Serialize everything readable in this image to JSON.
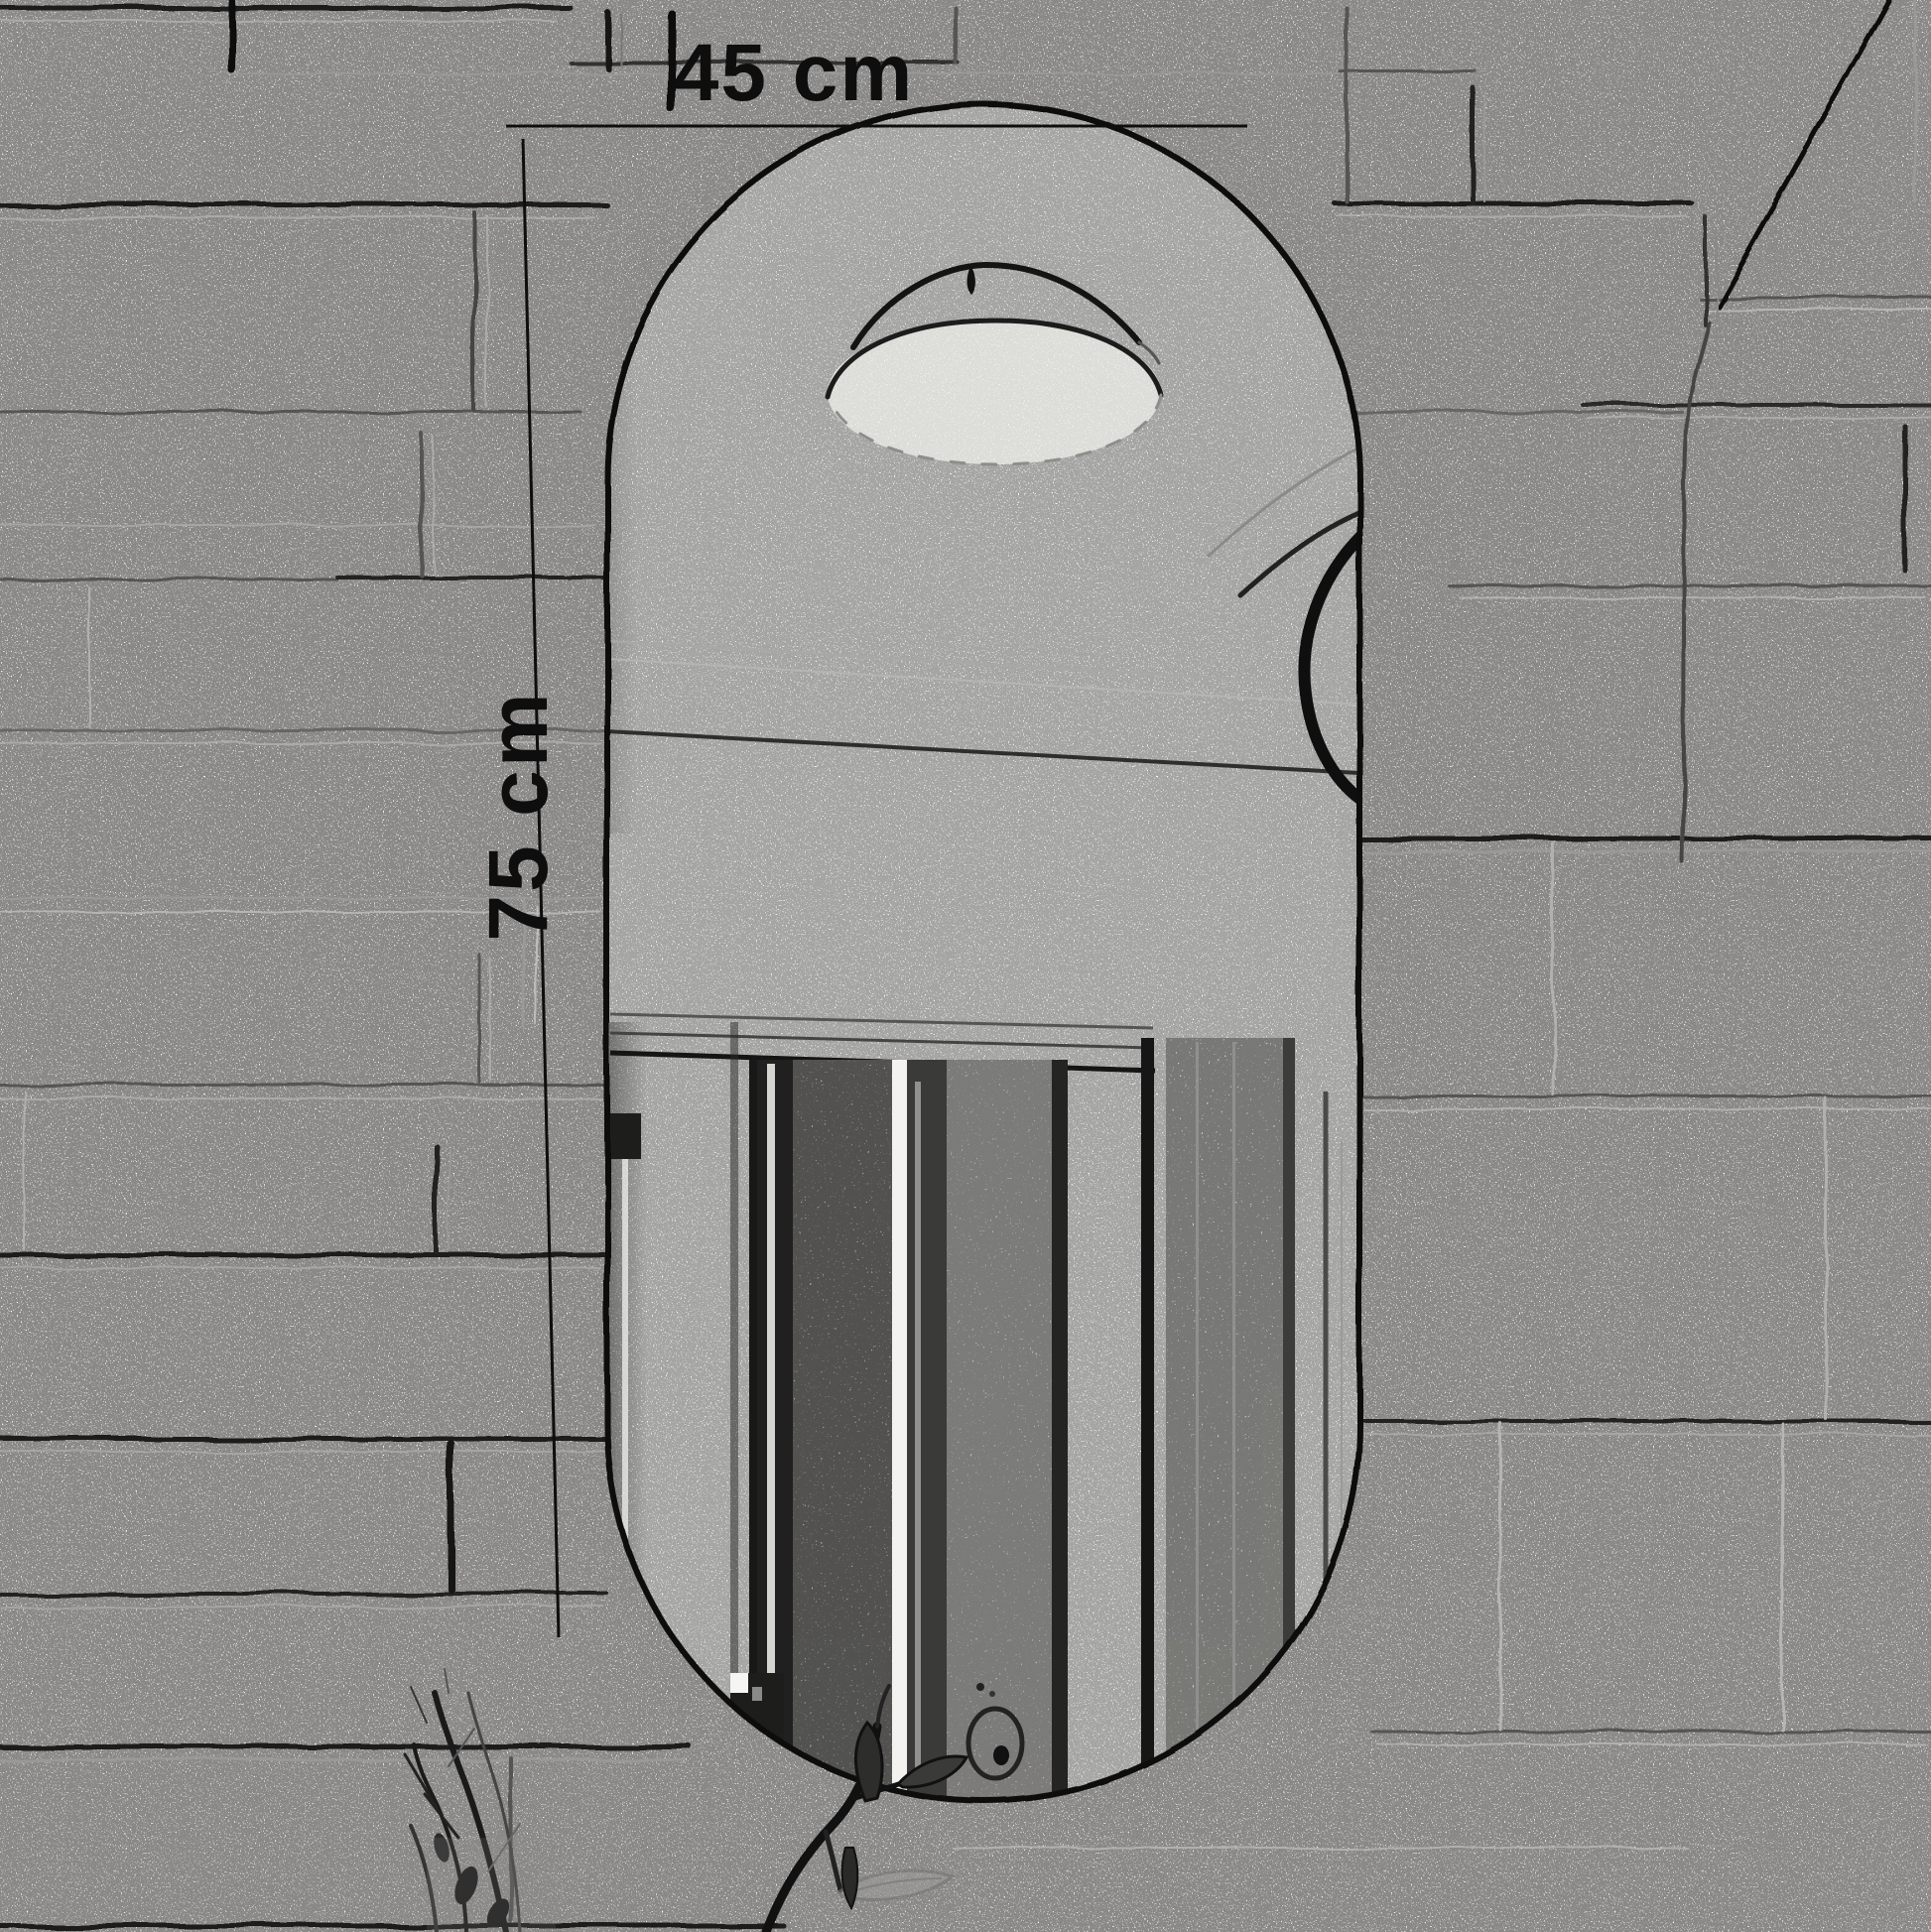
{
  "diagram": {
    "type": "product-dimension-sketch",
    "subject": "capsule-shaped wall mirror on brick tile wall (pencil sketch style)",
    "annotations": {
      "width_label": "45 cm",
      "height_label": "75 cm",
      "width_value": 45,
      "height_value": 75,
      "unit": "cm"
    },
    "colors": {
      "ink": "#111111",
      "paper": "#fbfaf8",
      "faint_line": "#999999",
      "mid_line": "#555555",
      "mirror_fill": "#fdfdfb"
    },
    "elements": [
      "brick-wall",
      "mirror",
      "ceiling-light-reflection",
      "door-reflection",
      "faucet-reflection",
      "plant-sketch",
      "twig-sketch",
      "diagonal-crack"
    ]
  }
}
